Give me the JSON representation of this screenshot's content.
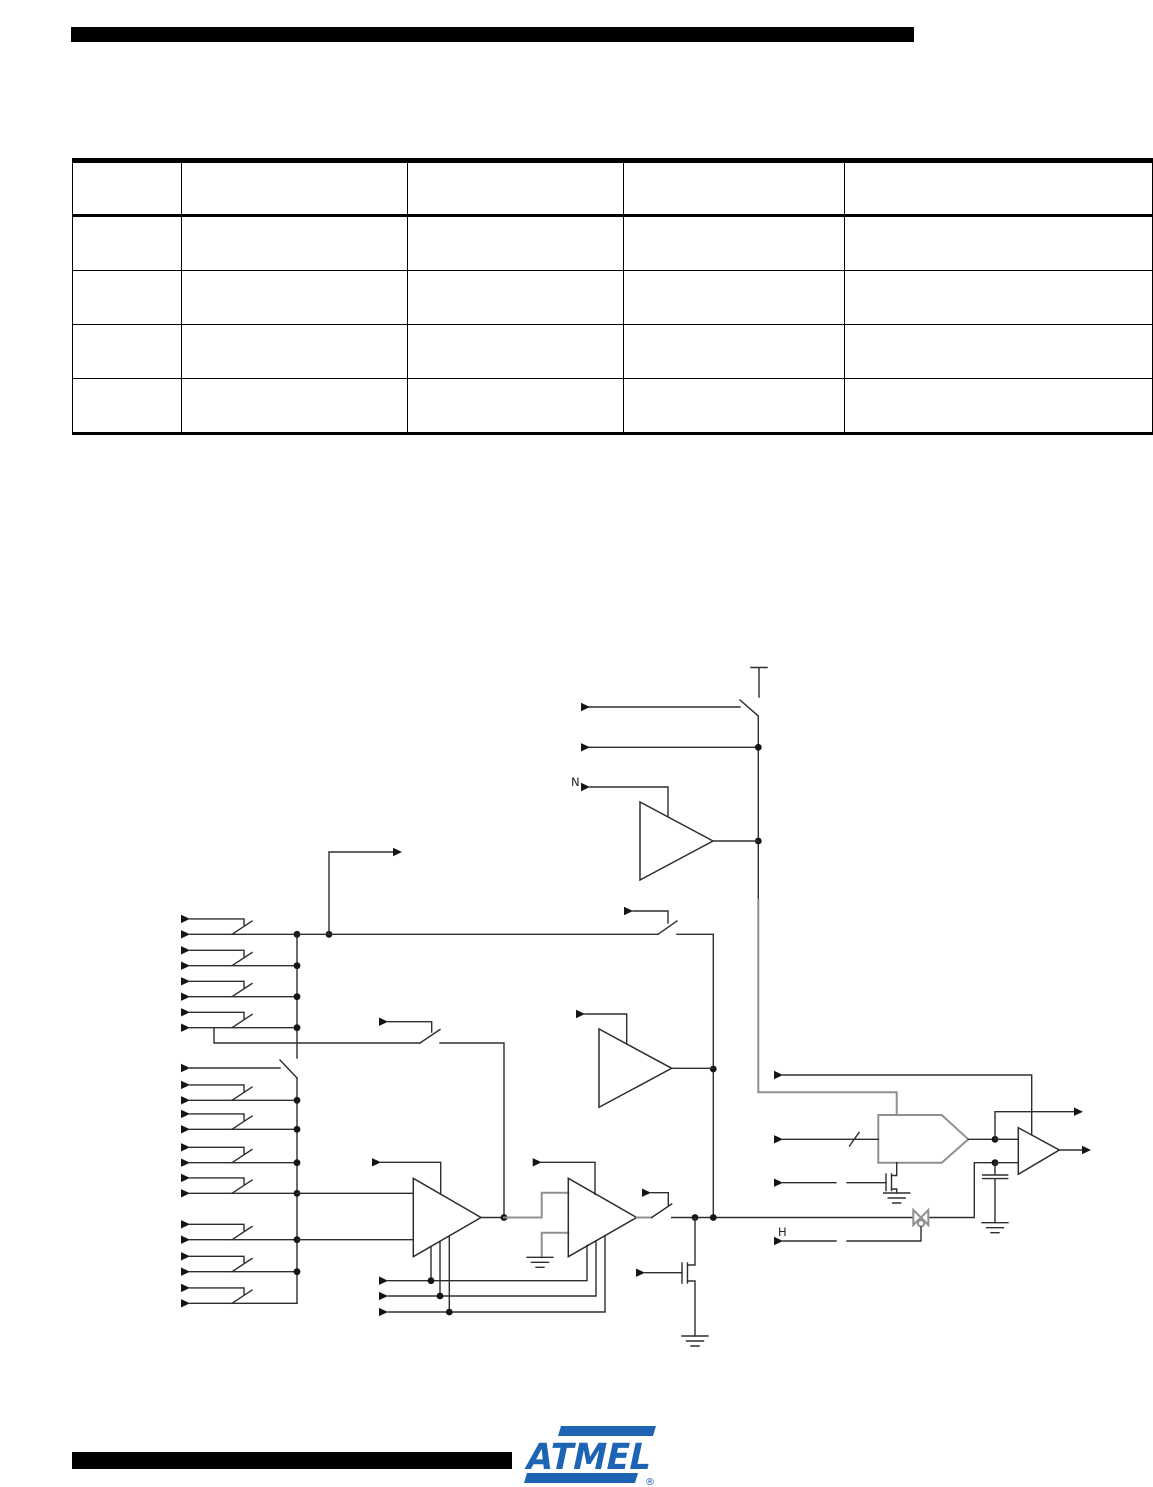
{
  "table": {
    "columns": [
      "",
      "",
      "",
      "",
      ""
    ],
    "rows": [
      [
        "",
        "",
        "",
        "",
        ""
      ],
      [
        "",
        "",
        "",
        "",
        ""
      ],
      [
        "",
        "",
        "",
        "",
        ""
      ],
      [
        "",
        "",
        "",
        "",
        ""
      ]
    ]
  },
  "diagram": {
    "labels": {
      "n": "N",
      "h": "H"
    },
    "ink_color": "#2e2e2e"
  },
  "footer": {
    "logo_text": "ATMEL",
    "registered_mark": "®",
    "brand_color": "#1d64b4"
  }
}
